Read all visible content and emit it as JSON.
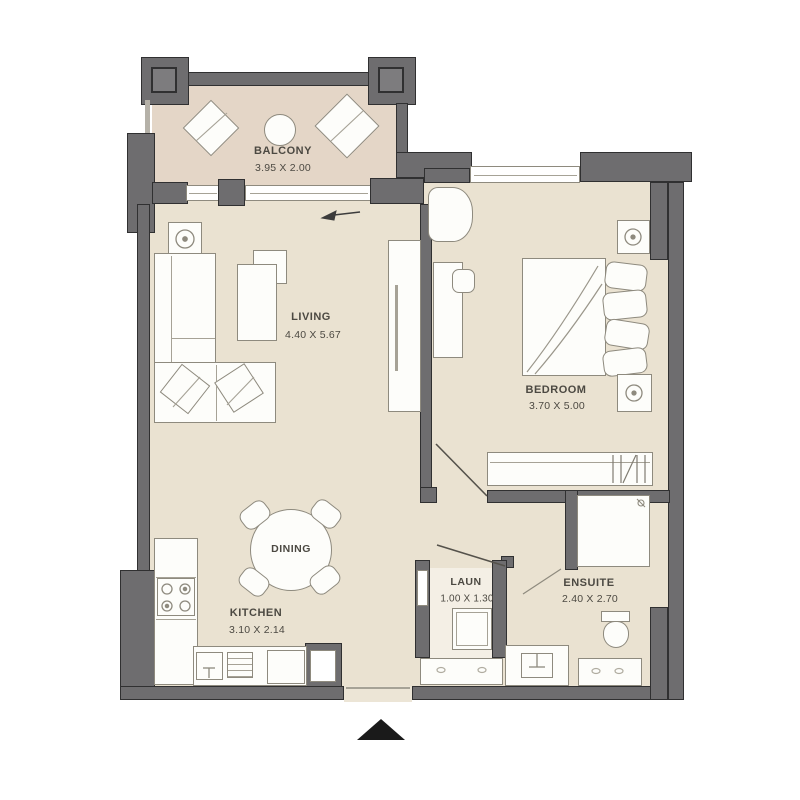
{
  "plan": {
    "type": "apartment-floor-plan",
    "rooms": [
      {
        "id": "balcony",
        "label": "BALCONY",
        "dims": "3.95 X 2.00"
      },
      {
        "id": "living",
        "label": "LIVING",
        "dims": "4.40 X 5.67"
      },
      {
        "id": "bedroom",
        "label": "BEDROOM",
        "dims": "3.70 X 5.00"
      },
      {
        "id": "dining",
        "label": "DINING",
        "dims": ""
      },
      {
        "id": "kitchen",
        "label": "KITCHEN",
        "dims": "3.10 X 2.14"
      },
      {
        "id": "laundry",
        "label": "LAUN",
        "dims": "1.00 X 1.30"
      },
      {
        "id": "ensuite",
        "label": "ENSUITE",
        "dims": "2.40 X 2.70"
      }
    ],
    "entrance": {
      "icon": "triangle-up"
    },
    "colors": {
      "wall": "#6e6d6f",
      "wall_edge": "#303031",
      "pillar_inner": "#7d7c7e",
      "floor": "#eae2d1",
      "balcony_floor": "#e4d6c7",
      "laundry_floor": "#f4efe5",
      "entry_floor": "#ece5d6",
      "furniture_fill": "#fdfdfa",
      "furniture_line": "#8e8a7e",
      "detail_line": "#a6a296",
      "text": "#4c4942",
      "entrance_marker": "#1a1a1a",
      "bg": "#ffffff"
    }
  }
}
